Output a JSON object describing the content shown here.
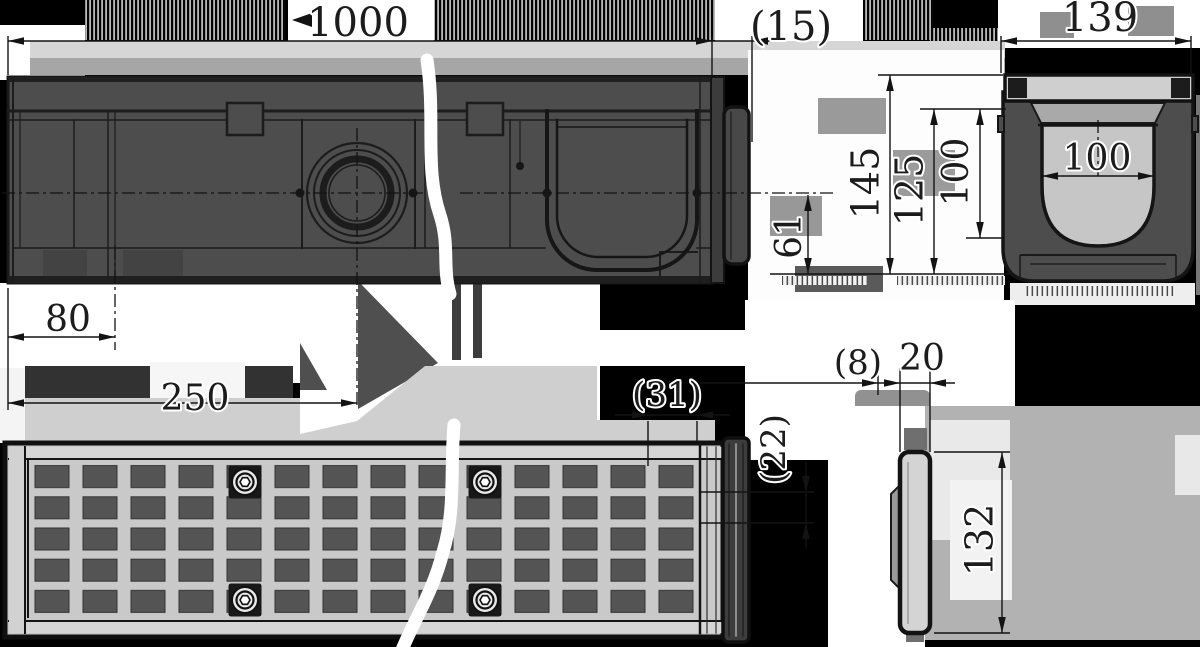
{
  "drawing": {
    "dimensions": {
      "length": "1000",
      "end_cap_offset": "(15)",
      "overall_width": "139",
      "inner_width": "100",
      "overall_height": "145",
      "body_height": "125",
      "inner_height": "100",
      "outlet_height": "61",
      "bottom_outlet_offset": "80",
      "side_outlet_offset": "250",
      "end_detail_width": "(31)",
      "edge_detail": "(22)",
      "cap_lip": "(8)",
      "cap_width": "20",
      "cap_height": "132"
    },
    "colors": {
      "background": "#000000",
      "body_fill": "#4d4d4d",
      "outline": "#161616",
      "grate_fill": "#c9c9c9",
      "dim_text": "#1c1c1c"
    }
  }
}
